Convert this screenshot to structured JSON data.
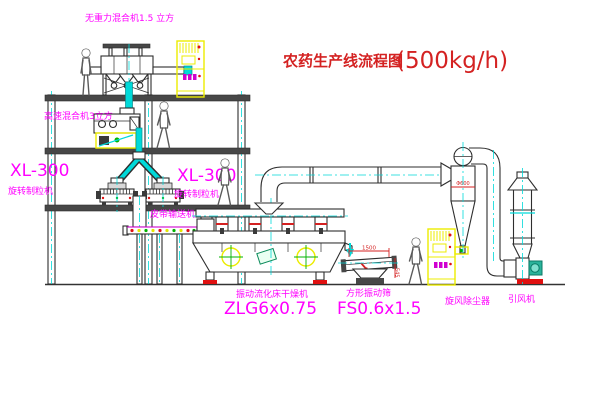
{
  "title": {
    "text": "农药生产线流程图",
    "capacity": "(500kg/h)"
  },
  "equipment": {
    "mixer_top": {
      "label": "无重力混合机1.5 立方"
    },
    "mixer_2f": {
      "label": "高速混合机3立方"
    },
    "granulator_left": {
      "model": "XL-300",
      "name": "旋转制粒机"
    },
    "granulator_right": {
      "model": "XL-300",
      "name": "旋转制粒机"
    },
    "belt_conveyor": {
      "name": "皮带输送机"
    },
    "dryer": {
      "name": "振动流化床干燥机",
      "model": "ZLG6x0.75"
    },
    "sieve": {
      "name": "方形振动筛",
      "model": "FS0.6x1.5",
      "dim_width": "1500",
      "dim_height": "545"
    },
    "cyclone": {
      "name": "旋风除尘器",
      "dim": "Φ600"
    },
    "fan": {
      "name": "引风机"
    }
  },
  "colors": {
    "label_magenta": "#ff00ff",
    "title_red": "#d42222",
    "centerline_cyan": "#00d9d9",
    "cabinet_yellow": "#ecec00",
    "line_dark": "#2e2e2e",
    "status_green": "#00b300",
    "base_red": "#e01010"
  }
}
